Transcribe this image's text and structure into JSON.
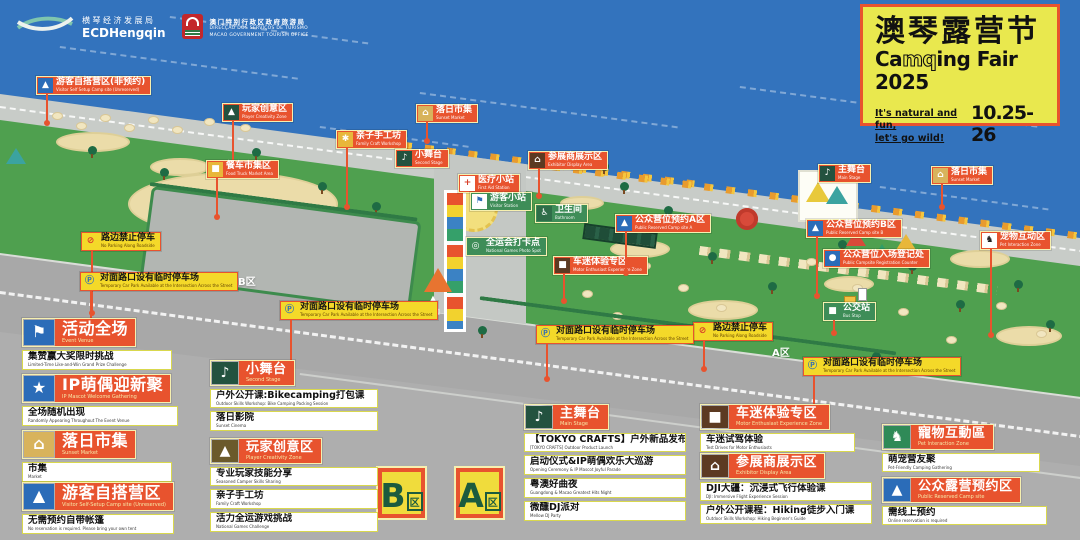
{
  "header": {
    "ecd": {
      "cn": "横琴经济发展局",
      "en": "ECDHengqin"
    },
    "mgto": {
      "cn": "澳门特别行政区政府旅游局",
      "line1": "DIRECÇÃO DOS SERVIÇOS DE TURISMO",
      "line2": "MACAO GOVERNMENT TOURISM OFFICE"
    },
    "title_box": {
      "cn": "澳琴露营节",
      "en_pre": "Ca",
      "en_mq": "mq",
      "en_post": "ing Fair 2025",
      "tag1": "It's natural and fun,",
      "tag2": "let's go wild!",
      "dates": "10.25- 26"
    }
  },
  "colors": {
    "accent_red": "#E8532E",
    "label_yellow": "#F4D929",
    "water_blue": "#3373BD",
    "grass_green": "#4FA04F",
    "road_gray": "#A8A8A8",
    "title_yellow": "#E9E84E",
    "icon_blue": "#2B6CB8",
    "icon_dark_green": "#23523F"
  },
  "icons": {
    "tent": "▲",
    "hand": "✱",
    "market": "⌂",
    "stage": "♪",
    "truck": "■",
    "cross": "+",
    "flag": "⚑",
    "lantern": "⌂",
    "restroom": "♿",
    "rings": "◎",
    "jeep": "■",
    "registration": "●",
    "dog": "♞",
    "no-parking": "⊘",
    "parking": "Ⓟ",
    "bus": "■",
    "star": "★"
  },
  "map": {
    "entrance": {
      "label": "入口"
    },
    "road_texts": [
      {
        "text": "B区",
        "x": 238,
        "y": 273
      },
      {
        "text": "A区",
        "x": 772,
        "y": 344
      }
    ],
    "zone_badges": [
      {
        "letter": "B",
        "suffix": "区",
        "x": 378,
        "y": 468
      },
      {
        "letter": "A",
        "suffix": "区",
        "x": 456,
        "y": 468
      }
    ],
    "labels": [
      {
        "text": "游客自搭营区(非预约)",
        "en": "Visitor Self Setup Camp site (Unreserved)",
        "x": 36,
        "y": 76,
        "variant": "red",
        "icon": "tent",
        "icon_bg": "#2B6CB8",
        "stem": 28
      },
      {
        "text": "玩家创意区",
        "en": "Player Creativity Zone",
        "x": 222,
        "y": 103,
        "variant": "red",
        "icon": "tent",
        "icon_bg": "#23523F",
        "stem": 45
      },
      {
        "text": "亲子手工坊",
        "en": "Family Craft Workshop",
        "x": 336,
        "y": 130,
        "variant": "red",
        "icon": "hand",
        "icon_bg": "#E8B73A",
        "stem": 58
      },
      {
        "text": "落日市集",
        "en": "Sunset Market",
        "x": 416,
        "y": 104,
        "variant": "red",
        "icon": "market",
        "icon_bg": "#D8B35C",
        "stem": 18
      },
      {
        "text": "小舞台",
        "en": "Second Stage",
        "x": 395,
        "y": 149,
        "variant": "red",
        "icon": "stage",
        "icon_bg": "#23523F"
      },
      {
        "text": "餐车市集区",
        "en": "Food Truck Market Area",
        "x": 206,
        "y": 160,
        "variant": "red",
        "icon": "truck",
        "icon_bg": "#E8B73A",
        "stem": 38
      },
      {
        "text": "医疗小站",
        "en": "First Aid Station",
        "x": 458,
        "y": 174,
        "variant": "red",
        "icon": "cross",
        "icon_bg": "#FFFFFF",
        "icon_color": "#D8402A"
      },
      {
        "text": "游客小站",
        "en": "Visitor Station",
        "x": 470,
        "y": 192,
        "variant": "green",
        "icon": "flag",
        "icon_bg": "#FFFFFF",
        "icon_color": "#2B6CB8"
      },
      {
        "text": "参展商展示区",
        "en": "Exhibitor Display Area",
        "x": 528,
        "y": 151,
        "variant": "red",
        "icon": "lantern",
        "icon_bg": "#5C3A22",
        "stem": 26
      },
      {
        "text": "卫生间",
        "en": "Bathroom",
        "x": 535,
        "y": 204,
        "variant": "green",
        "icon": "restroom",
        "icon_bg": "#2F6E49"
      },
      {
        "text": "全运会打卡点",
        "en": "National Games Photo Spot",
        "x": 466,
        "y": 237,
        "variant": "green",
        "icon": "rings",
        "icon_bg": "transparent"
      },
      {
        "text": "车迷体验专区",
        "en": "Motor Enthusiast Experience Zone",
        "x": 553,
        "y": 256,
        "variant": "red",
        "icon": "jeep",
        "icon_bg": "#5C3A22",
        "stem": 26
      },
      {
        "text": "公众营位预约A区",
        "en": "Public Reserved Camp site A",
        "x": 615,
        "y": 214,
        "variant": "red",
        "icon": "tent",
        "icon_bg": "#2B6CB8",
        "stem": 40
      },
      {
        "text": "主舞台",
        "en": "Main Stage",
        "x": 818,
        "y": 164,
        "variant": "red",
        "icon": "stage",
        "icon_bg": "#23523F"
      },
      {
        "text": "落日市集",
        "en": "Sunset Market",
        "x": 931,
        "y": 166,
        "variant": "red",
        "icon": "market",
        "icon_bg": "#D8B35C",
        "stem": 22
      },
      {
        "text": "公众营位预约B区",
        "en": "Public Reserved Camp site B",
        "x": 806,
        "y": 219,
        "variant": "red",
        "icon": "tent",
        "icon_bg": "#2B6CB8",
        "stem": 58
      },
      {
        "text": "公众营位入场登记处",
        "en": "Public Campsite Registration Counter",
        "x": 823,
        "y": 249,
        "variant": "red",
        "icon": "registration",
        "icon_bg": "#2B6CB8"
      },
      {
        "text": "宠物互动区",
        "en": "Pet Interaction Zone",
        "x": 980,
        "y": 231,
        "variant": "red",
        "icon": "dog",
        "icon_bg": "#FFFFFF",
        "icon_color": "#222222",
        "stem": 85
      },
      {
        "text": "路边禁止停车",
        "en": "No Parking Along Roadside",
        "x": 81,
        "y": 232,
        "variant": "yellow",
        "icon": "no-parking",
        "icon_bg": "transparent",
        "icon_color": "#D8402A",
        "stem": 62
      },
      {
        "text": "路边禁止停车",
        "en": "No Parking Along Roadside",
        "x": 693,
        "y": 322,
        "variant": "yellow",
        "icon": "no-parking",
        "icon_bg": "transparent",
        "icon_color": "#D8402A",
        "stem": 28
      },
      {
        "text": "对面路口设有临时停车场",
        "en": "Temporary Car Park Available at the Intersection Across the Street",
        "x": 80,
        "y": 272,
        "variant": "yellow",
        "icon": "parking",
        "icon_bg": "transparent",
        "icon_color": "#2B6CB8",
        "stem": 45
      },
      {
        "text": "对面路口设有临时停车场",
        "en": "Temporary Car Park Available at the Intersection Across the Street",
        "x": 280,
        "y": 301,
        "variant": "yellow",
        "icon": "parking",
        "icon_bg": "transparent",
        "icon_color": "#2B6CB8",
        "stem": 48
      },
      {
        "text": "对面路口设有临时停车场",
        "en": "Temporary Car Park Available at the Intersection Across the Street",
        "x": 536,
        "y": 325,
        "variant": "yellow",
        "icon": "parking",
        "icon_bg": "transparent",
        "icon_color": "#2B6CB8",
        "stem": 35
      },
      {
        "text": "对面路口设有临时停车场",
        "en": "Temporary Car Park Available at the Intersection Across the Street",
        "x": 803,
        "y": 357,
        "variant": "yellow",
        "icon": "parking",
        "icon_bg": "transparent",
        "icon_color": "#2B6CB8",
        "stem": 42
      },
      {
        "text": "公交站",
        "en": "Bus Stop",
        "x": 823,
        "y": 302,
        "variant": "green",
        "icon": "bus",
        "icon_bg": "transparent",
        "stem": 12
      }
    ]
  },
  "legend": {
    "blocks": [
      {
        "title": "活动全场",
        "en": "Event Venue",
        "icon": "flag",
        "icon_bg": "#2B6CB8",
        "x": 22,
        "y": 318,
        "w": 150,
        "size": "lg",
        "items": [
          {
            "text": "集赞赢大奖限时挑战",
            "en": "Limited-Time Like-and-Win Grand Prize Challenge"
          }
        ]
      },
      {
        "title": "IP萌偶迎新聚",
        "en": "IP Mascot Welcome Gathering",
        "icon": "star",
        "icon_bg": "#2B6CB8",
        "x": 22,
        "y": 374,
        "w": 156,
        "size": "lg",
        "items": [
          {
            "text": "全场随机出现",
            "en": "Randomly Appearing Throughout The Event Venue"
          }
        ]
      },
      {
        "title": "落日市集",
        "en": "Sunset Market",
        "icon": "market",
        "icon_bg": "#D8B35C",
        "x": 22,
        "y": 430,
        "w": 150,
        "size": "lg",
        "items": [
          {
            "text": "市集",
            "en": "Market"
          }
        ]
      },
      {
        "title": "游客自搭营区",
        "en": "Visitor Self-Setup Camp site (Unreserved)",
        "icon": "tent",
        "icon_bg": "#2B6CB8",
        "x": 22,
        "y": 482,
        "w": 152,
        "size": "lg",
        "items": [
          {
            "text": "无需预约自带帐篷",
            "en": "No reservation is required. Please bring your own tent"
          }
        ]
      },
      {
        "title": "小舞台",
        "en": "Second Stage",
        "icon": "stage",
        "icon_bg": "#23523F",
        "x": 210,
        "y": 360,
        "w": 168,
        "items": [
          {
            "text": "户外公开课:Bikecamping打包课",
            "en": "Outdoor Skills Workshop: Bike Camping Packing Session"
          },
          {
            "text": "落日影院",
            "en": "Sunset Cinema"
          }
        ]
      },
      {
        "title": "玩家创意区",
        "en": "Player Creativity Zone",
        "icon": "tent",
        "icon_bg": "#6B5A2B",
        "x": 210,
        "y": 438,
        "w": 168,
        "items": [
          {
            "text": "专业玩家技能分享",
            "en": "Seasoned Camper Skills Sharing"
          },
          {
            "text": "亲子手工坊",
            "en": "Family Craft Workshop"
          },
          {
            "text": "活力全运游戏挑战",
            "en": "National Games Challenge"
          }
        ]
      },
      {
        "title": "主舞台",
        "en": "Main Stage",
        "icon": "stage",
        "icon_bg": "#23523F",
        "x": 524,
        "y": 404,
        "w": 162,
        "items": [
          {
            "text": "【TOKYO CRAFTS】户外新品发布",
            "en": "[TOKYO CRAFTS] Outdoor Product Launch"
          },
          {
            "text": "启动仪式&IP萌偶欢乐大巡游",
            "en": "Opening Ceremony & IP Mascot Joyful Parade"
          },
          {
            "text": "粤澳好曲夜",
            "en": "Guangdong & Macao Greatest Hits Night"
          },
          {
            "text": "微醺DJ派对",
            "en": "Mellow DJ Party"
          }
        ]
      },
      {
        "title": "车迷体验专区",
        "en": "Motor Enthusiast Experience Zone",
        "icon": "jeep",
        "icon_bg": "#5C3A22",
        "x": 700,
        "y": 404,
        "w": 155,
        "items": [
          {
            "text": "车迷试驾体验",
            "en": "Test Drives for Motor Enthusiasts"
          }
        ]
      },
      {
        "title": "参展商展示区",
        "en": "Exhibitor Display Area",
        "icon": "lantern",
        "icon_bg": "#5C3A22",
        "x": 700,
        "y": 453,
        "w": 172,
        "items": [
          {
            "text": "DJI大疆：沉浸式飞行体验课",
            "en": "DJI: Immersive Flight Experience Session"
          },
          {
            "text": "户外公开课程：Hiking徒步入门课",
            "en": "Outdoor Skills Workshop: Hiking Beginner's Guide"
          }
        ]
      },
      {
        "title": "寵物互動區",
        "en": "Pet Interaction Zone",
        "icon": "dog",
        "icon_bg": "#2F8A57",
        "x": 882,
        "y": 424,
        "w": 158,
        "items": [
          {
            "text": "萌宠营友聚",
            "en": "Pet-Friendly Camping Gathering"
          }
        ]
      },
      {
        "title": "公众露营预约区",
        "en": "Public Reserved Camp site",
        "icon": "tent",
        "icon_bg": "#2B6CB8",
        "x": 882,
        "y": 477,
        "w": 165,
        "items": [
          {
            "text": "需线上预约",
            "en": "Online reservation is required"
          }
        ]
      }
    ]
  }
}
